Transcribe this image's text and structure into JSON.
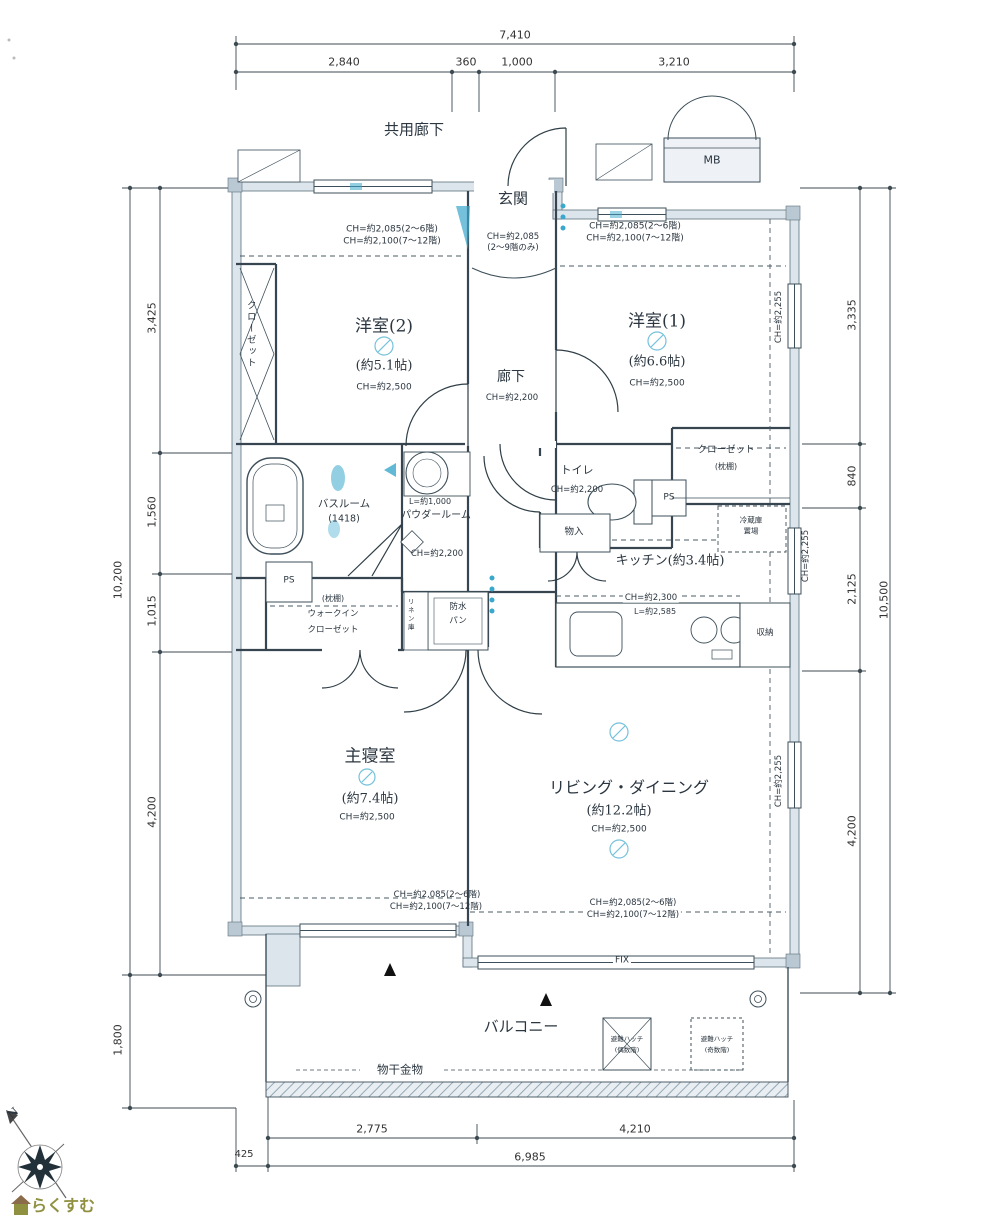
{
  "dims": {
    "top_total": "7,410",
    "top_seg": [
      "2,840",
      "360",
      "1,000",
      "3,210"
    ],
    "left_total": "10,200",
    "left_seg": [
      "3,425",
      "1,560",
      "1,015",
      "4,200"
    ],
    "left_bottom": "1,800",
    "right_total": "10,500",
    "right_seg": [
      "3,335",
      "840",
      "2,125",
      "4,200"
    ],
    "bottom_seg": [
      "2,775",
      "4,210"
    ],
    "bottom_offset": "425",
    "bottom_total": "6,985"
  },
  "rooms": {
    "common_corridor": "共用廊下",
    "mb": "MB",
    "entrance": {
      "name": "玄関",
      "ch": "CH=約2,085",
      "ch_note": "(2〜9階のみ)"
    },
    "hallway": {
      "name": "廊下",
      "ch": "CH=約2,200"
    },
    "western2": {
      "name": "洋室(2)",
      "size": "(約5.1帖)",
      "ch": "CH=約2,500"
    },
    "western1": {
      "name": "洋室(1)",
      "size": "(約6.6帖)",
      "ch": "CH=約2,500"
    },
    "master": {
      "name": "主寝室",
      "size": "(約7.4帖)",
      "ch": "CH=約2,500"
    },
    "living": {
      "name": "リビング・ダイニング",
      "size": "(約12.2帖)",
      "ch": "CH=約2,500"
    },
    "kitchen": {
      "name": "キッチン(約3.4帖)",
      "ch": "CH=約2,300",
      "counter": "L=約2,585",
      "storage": "収納",
      "fridge1": "冷蔵庫",
      "fridge2": "置場",
      "pantry": "物入"
    },
    "toilet": {
      "name": "トイレ",
      "ch": "CH=約2,200"
    },
    "bath": {
      "name": "バスルーム",
      "size": "(1418)"
    },
    "powder": {
      "name": "パウダールーム",
      "l": "L=約1,000",
      "ch": "CH=約2,200",
      "linen": "リネン庫"
    },
    "wic": {
      "note": "(枕棚)",
      "name1": "ウォークイン",
      "name2": "クローゼット"
    },
    "closet_w2": "クローゼット",
    "closet_w1": {
      "name": "クローゼット",
      "note": "(枕棚)"
    },
    "ps": "PS",
    "pan1": "防水",
    "pan2": "パン",
    "balcony": "バルコニー",
    "drying": "物干金物",
    "fix": "FIX",
    "hatch": {
      "name": "避難ハッチ",
      "even": "(偶数階)",
      "odd": "(奇数階)"
    }
  },
  "ch_notes": {
    "low": "CH=約2,085(2〜6階)",
    "high": "CH=約2,100(7〜12階)",
    "side": "CH=約2,255"
  },
  "compass": {
    "n": "N"
  },
  "logo": {
    "text": "らくすむ"
  },
  "colors": {
    "wall": "#dce5ec",
    "line": "#3d4f5a",
    "blue": "#3aa7cc",
    "logo": "#8f9040"
  }
}
